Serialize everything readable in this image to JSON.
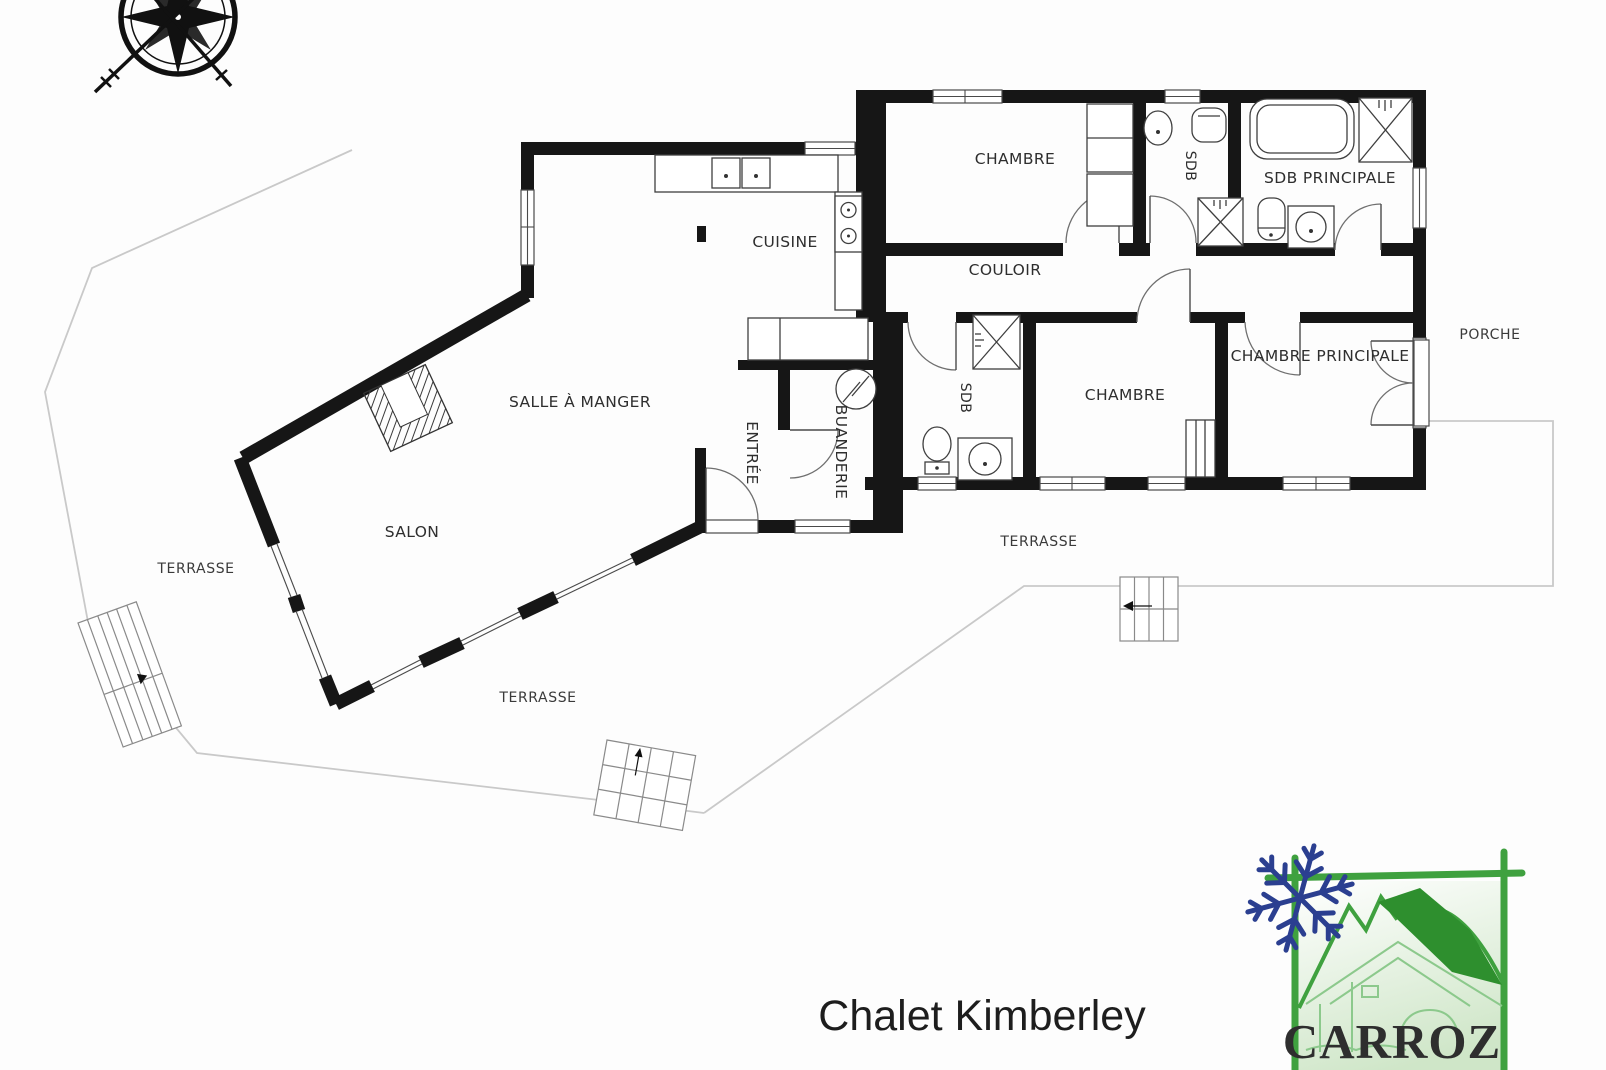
{
  "plan": {
    "compass_icon": "compass-rose",
    "rooms": {
      "chambre_top": "CHAMBRE",
      "sdb_top": "SDB",
      "sdb_principale": "SDB PRINCIPALE",
      "cuisine": "CUISINE",
      "couloir": "COULOIR",
      "chambre_principale": "CHAMBRE PRINCIPALE",
      "chambre_bas": "CHAMBRE",
      "sdb_bas": "SDB",
      "salle_a_manger": "SALLE À MANGER",
      "entree": "ENTRÉE",
      "buanderie": "BUANDERIE",
      "salon": "SALON"
    },
    "outdoor": {
      "porche": "PORCHE",
      "terrasse_gauche": "TERRASSE",
      "terrasse_bas": "TERRASSE",
      "terrasse_droite": "TERRASSE"
    },
    "title": "Chalet Kimberley"
  },
  "logo": {
    "brand": "CARROZ",
    "snowflake_icon": "snowflake",
    "frame_color": "#3fa13f",
    "brand_color": "#20307a",
    "snowflake_color": "#2b3f90"
  },
  "colors": {
    "wall": "#161616",
    "window_frame": "#4a4a4a",
    "terrace_line": "#c9c9c9",
    "background": "#ffffff"
  }
}
